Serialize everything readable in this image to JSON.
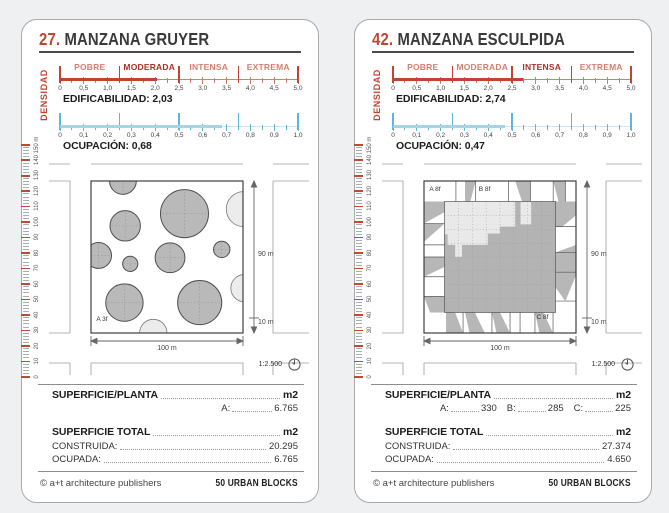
{
  "footer": {
    "copyright": "© a+t architecture publishers",
    "series": "50 URBAN BLOCKS"
  },
  "dims": {
    "height": "90 m",
    "street": "10 m",
    "width": "100 m"
  },
  "scale_note": "1:2.500",
  "density_scale": {
    "max": 5,
    "tick_labels": [
      "0",
      "0,5",
      "1,0",
      "1,5",
      "2,0",
      "2,5",
      "3,0",
      "3,5",
      "4,0",
      "4,5",
      "5,0"
    ],
    "category_bounds": [
      0,
      1.25,
      2.5,
      3.75,
      5
    ],
    "categories": [
      "POBRE",
      "MODERADA",
      "INTENSA",
      "EXTREMA"
    ]
  },
  "occupancy_scale": {
    "max": 1,
    "tick_labels": [
      "0",
      "0,1",
      "0,2",
      "0,3",
      "0,4",
      "0,5",
      "0,6",
      "0,7",
      "0,8",
      "0,9",
      "1,0"
    ],
    "category_bounds": [
      0,
      0.25,
      0.5,
      0.75,
      1
    ]
  },
  "ruler": {
    "unit": "m",
    "max": 150,
    "major_step": 10,
    "top_label": "150 m"
  },
  "colors": {
    "red": "#c14433",
    "red_dark": "#aa3124",
    "red_light": "#d37f6f",
    "blue": "#a6d3e5",
    "blue_tick": "#5fb6d8",
    "solid_fill": "#b9b9b9",
    "light_fill": "#ececec",
    "core_dark": "#b3b3b3"
  },
  "cards": [
    {
      "number": "27.",
      "title": "MANZANA GRUYER",
      "densidad": "DENSIDAD",
      "edificabilidad_text": "EDIFICABILIDAD: 2,03",
      "edificabilidad_value": 2.03,
      "active_category": "MODERADA",
      "ocupacion_text": "OCUPACIÓN: 0,68",
      "ocupacion_value": 0.68,
      "diagram": {
        "type": "circles",
        "labels": [
          {
            "text": "A 3f",
            "fx": 0.035,
            "fy": 0.885
          }
        ],
        "circles": [
          {
            "x": 0.21,
            "y": 0.0,
            "r": 0.088,
            "solid": true
          },
          {
            "x": 0.615,
            "y": 0.215,
            "r": 0.158,
            "solid": true
          },
          {
            "x": 0.225,
            "y": 0.295,
            "r": 0.1,
            "solid": true
          },
          {
            "x": 1.005,
            "y": 0.185,
            "r": 0.115,
            "solid": false
          },
          {
            "x": 0.05,
            "y": 0.49,
            "r": 0.085,
            "solid": true
          },
          {
            "x": 0.258,
            "y": 0.545,
            "r": 0.05,
            "solid": true
          },
          {
            "x": 0.52,
            "y": 0.505,
            "r": 0.098,
            "solid": true
          },
          {
            "x": 0.86,
            "y": 0.45,
            "r": 0.054,
            "solid": true
          },
          {
            "x": 1.01,
            "y": 0.705,
            "r": 0.09,
            "solid": false
          },
          {
            "x": 0.22,
            "y": 0.8,
            "r": 0.123,
            "solid": true
          },
          {
            "x": 0.715,
            "y": 0.8,
            "r": 0.145,
            "solid": true
          },
          {
            "x": 0.41,
            "y": 1.0,
            "r": 0.09,
            "solid": false
          }
        ]
      },
      "superficie_planta": {
        "label": "SUPERFICIE/PLANTA",
        "unit": "m2",
        "entries": [
          {
            "key": "A:",
            "value": "6.765"
          }
        ]
      },
      "superficie_total": {
        "label": "SUPERFICIE TOTAL",
        "unit": "m2",
        "rows": [
          {
            "key": "CONSTRUIDA:",
            "value": "20.295"
          },
          {
            "key": "OCUPADA:",
            "value": "6.765"
          }
        ]
      }
    },
    {
      "number": "42.",
      "title": "MANZANA ESCULPIDA",
      "densidad": "DENSIDAD",
      "edificabilidad_text": "EDIFICABILIDAD: 2,74",
      "edificabilidad_value": 2.74,
      "active_category": "INTENSA",
      "ocupacion_text": "OCUPACIÓN: 0,47",
      "ocupacion_value": 0.47,
      "diagram": {
        "type": "sculpted",
        "labels": [
          {
            "text": "A 8f",
            "fx": 0.035,
            "fy": 0.03
          },
          {
            "text": "B 8f",
            "fx": 0.36,
            "fy": 0.03
          },
          {
            "text": "C 8f",
            "fx": 0.74,
            "fy": 0.875
          }
        ],
        "band": 0.135,
        "dividers": {
          "top": [
            0.21,
            0.34,
            0.555,
            0.7,
            0.85,
            0.93
          ],
          "left": [
            0.28,
            0.42,
            0.5,
            0.63,
            0.76
          ],
          "right": [
            0.3,
            0.47,
            0.6,
            0.79
          ],
          "bottom": [
            0.257,
            0.447,
            0.566,
            0.632,
            0.73,
            0.849
          ]
        },
        "wedges": [
          [
            [
              0.27,
              0
            ],
            [
              0.34,
              0
            ],
            [
              0.305,
              0.135
            ],
            [
              0.27,
              0.135
            ]
          ],
          [
            [
              0.6,
              0
            ],
            [
              0.7,
              0
            ],
            [
              0.7,
              0.135
            ],
            [
              0.645,
              0.135
            ]
          ],
          [
            [
              0.85,
              0
            ],
            [
              0.93,
              0
            ],
            [
              0.93,
              0.135
            ],
            [
              0.885,
              0.135
            ]
          ],
          [
            [
              0,
              0.135
            ],
            [
              0.135,
              0.135
            ],
            [
              0.135,
              0.205
            ],
            [
              0,
              0.28
            ]
          ],
          [
            [
              0,
              0.28
            ],
            [
              0.135,
              0.28
            ],
            [
              0,
              0.4
            ]
          ],
          [
            [
              0,
              0.5
            ],
            [
              0.135,
              0.5
            ],
            [
              0.135,
              0.565
            ],
            [
              0,
              0.63
            ]
          ],
          [
            [
              0,
              0.76
            ],
            [
              0.135,
              0.76
            ],
            [
              0.135,
              0.865
            ],
            [
              0.04,
              0.865
            ]
          ],
          [
            [
              0.865,
              0.135
            ],
            [
              1,
              0.135
            ],
            [
              1,
              0.225
            ],
            [
              0.91,
              0.3
            ],
            [
              0.865,
              0.3
            ]
          ],
          [
            [
              0.865,
              0.47
            ],
            [
              1,
              0.42
            ],
            [
              1,
              0.62
            ],
            [
              0.93,
              0.79
            ],
            [
              0.865,
              0.7
            ]
          ],
          [
            [
              0.145,
              0.865
            ],
            [
              0.205,
              0.865
            ],
            [
              0.257,
              1
            ],
            [
              0.145,
              1
            ]
          ],
          [
            [
              0.27,
              0.865
            ],
            [
              0.335,
              0.865
            ],
            [
              0.4,
              1
            ],
            [
              0.3,
              1
            ]
          ],
          [
            [
              0.447,
              0.865
            ],
            [
              0.5,
              0.865
            ],
            [
              0.566,
              1
            ],
            [
              0.477,
              1
            ]
          ],
          [
            [
              0.73,
              0.865
            ],
            [
              0.785,
              0.865
            ],
            [
              0.849,
              1
            ],
            [
              0.76,
              1
            ]
          ]
        ],
        "core_poly": [
          [
            0.135,
            0.35
          ],
          [
            0.155,
            0.35
          ],
          [
            0.155,
            0.42
          ],
          [
            0.205,
            0.42
          ],
          [
            0.205,
            0.5
          ],
          [
            0.25,
            0.5
          ],
          [
            0.25,
            0.42
          ],
          [
            0.42,
            0.42
          ],
          [
            0.42,
            0.345
          ],
          [
            0.5,
            0.345
          ],
          [
            0.5,
            0.3
          ],
          [
            0.6,
            0.3
          ],
          [
            0.6,
            0.135
          ],
          [
            0.635,
            0.135
          ],
          [
            0.635,
            0.285
          ],
          [
            0.705,
            0.285
          ],
          [
            0.705,
            0.135
          ],
          [
            0.865,
            0.135
          ],
          [
            0.865,
            0.865
          ],
          [
            0.135,
            0.865
          ]
        ]
      },
      "superficie_planta": {
        "label": "SUPERFICIE/PLANTA",
        "unit": "m2",
        "entries": [
          {
            "key": "A:",
            "value": "330"
          },
          {
            "key": "B:",
            "value": "285"
          },
          {
            "key": "C:",
            "value": "225"
          }
        ]
      },
      "superficie_total": {
        "label": "SUPERFICIE TOTAL",
        "unit": "m2",
        "rows": [
          {
            "key": "CONSTRUIDA:",
            "value": "27.374"
          },
          {
            "key": "OCUPADA:",
            "value": "4.650"
          }
        ]
      }
    }
  ]
}
